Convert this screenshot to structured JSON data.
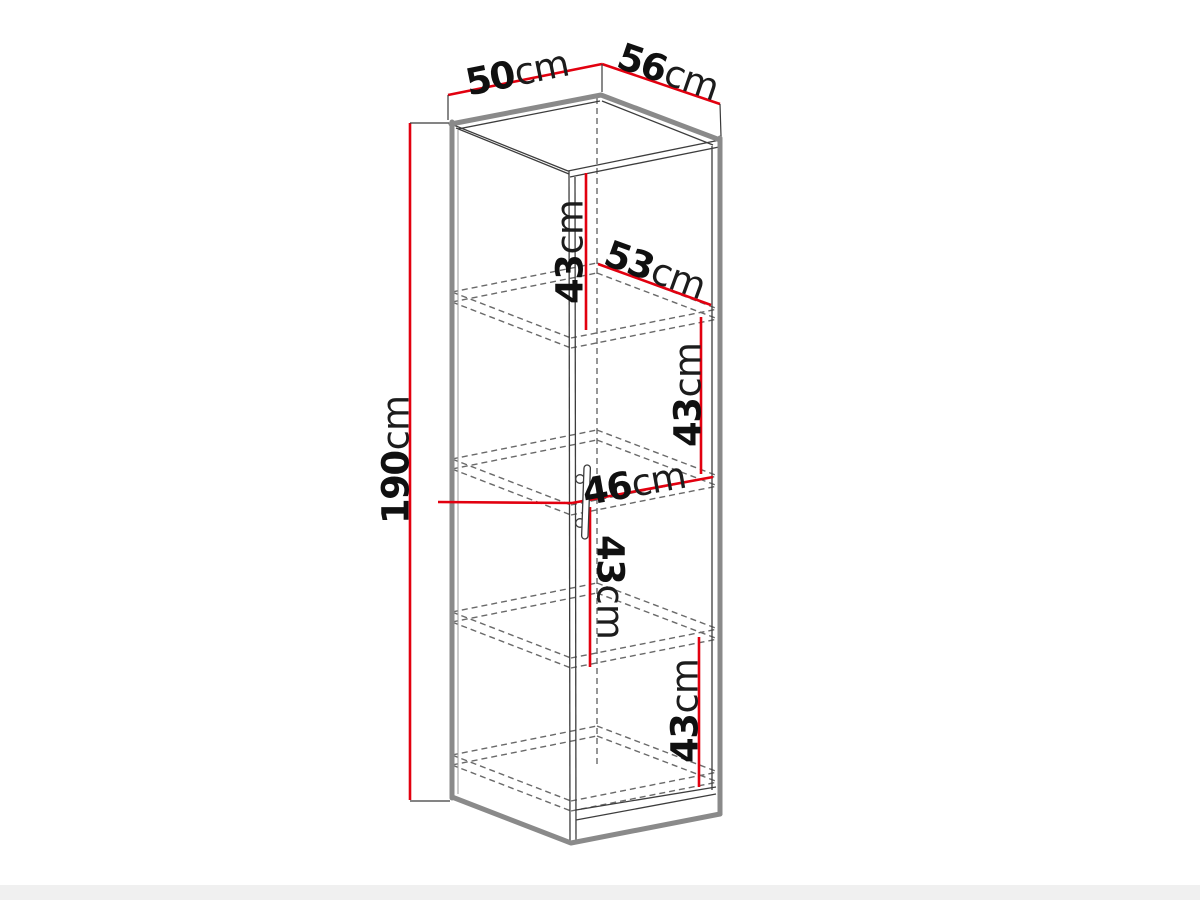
{
  "figure_alt": "Black-and-white 3D line drawing of a tall one-door cabinet with four shelf compartments, annotated with red dimension lines",
  "dimensions": {
    "top_width": {
      "number": "50",
      "unit": "cm"
    },
    "top_depth": {
      "number": "56",
      "unit": "cm"
    },
    "total_height": {
      "number": "190",
      "unit": "cm"
    },
    "compartment_1_height": {
      "number": "43",
      "unit": "cm"
    },
    "interior_depth": {
      "number": "53",
      "unit": "cm"
    },
    "compartment_2_height": {
      "number": "43",
      "unit": "cm"
    },
    "interior_width": {
      "number": "46",
      "unit": "cm"
    },
    "compartment_3_height": {
      "number": "43",
      "unit": "cm"
    },
    "compartment_4_height": {
      "number": "43",
      "unit": "cm"
    }
  },
  "colors": {
    "dimension_red": "#e2000f",
    "outline_gray": "#8a8a8a",
    "edge_dark": "#3d3d3d",
    "hidden_gray": "#6a6a6a",
    "text_dark": "#101010",
    "background": "#ffffff"
  }
}
